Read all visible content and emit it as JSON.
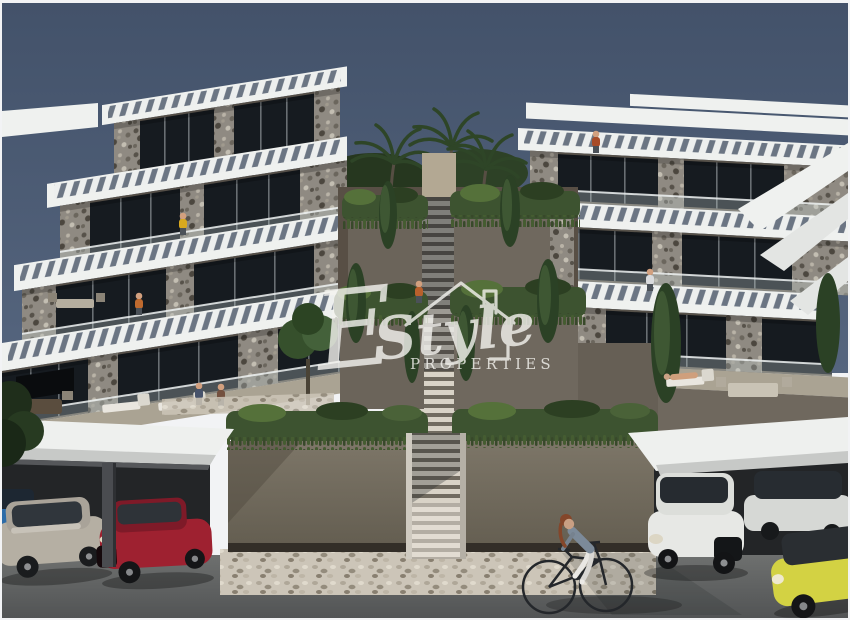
{
  "image": {
    "kind": "architectural 3D render",
    "subject": "terraced hillside apartment complex with pergola roofs, central landscaped staircase, covered parking and street scene at dusk"
  },
  "watermark": {
    "script_initial": "E",
    "script_name": "Style",
    "subtitle": "PROPERTIES",
    "icon": "house-outline-icon",
    "color": "#f5f4f0"
  },
  "palette": {
    "sky_top": "#43526a",
    "sky_bottom": "#55657e",
    "pergola_white": "#eff1ef",
    "stucco_wall": "#6c655b",
    "stone_cladding": "#8f8a82",
    "window_glass": "#161b20",
    "greenery": "#3d5330",
    "street_wall": "#7d7668",
    "road": "#606264",
    "pebble_path": "#ccc5b8",
    "garage_interior": "#232527"
  },
  "scene": {
    "sky": {
      "label": "dusk sky"
    },
    "left_building": {
      "label": "left terraced apartment block",
      "floors": 4,
      "features": [
        "slatted pergola roofs",
        "stone piers",
        "glass balustrades",
        "sun loungers",
        "wall tv"
      ]
    },
    "right_building": {
      "label": "right terraced apartment block",
      "floors": 4,
      "features": [
        "slatted pergola roofs",
        "white stair ramps",
        "roof terraces"
      ]
    },
    "center": {
      "label": "central landscaped staircase",
      "features": [
        "hanging plants",
        "cypress trees",
        "palm trees",
        "stone steps"
      ]
    },
    "street": {
      "label": "street level",
      "features": [
        "hedge-topped retaining walls",
        "pebble walkway",
        "asphalt road"
      ]
    },
    "parking": {
      "left_garage_cars": [
        {
          "label": "blue car",
          "color": "#2d6ca8"
        },
        {
          "label": "silver sedan",
          "color": "#b5afa3"
        },
        {
          "label": "red sedan",
          "color": "#9e2130"
        }
      ],
      "right_garage_cars": [
        {
          "label": "white sedan",
          "color": "#e7e8e5"
        },
        {
          "label": "white hatchback",
          "color": "#d6d8d5"
        },
        {
          "label": "yellow car",
          "color": "#d3d243"
        }
      ]
    },
    "figures": {
      "cyclist": "woman riding a bicycle along the street",
      "residents": "people standing on terraces and a woman on a sun lounger"
    }
  }
}
